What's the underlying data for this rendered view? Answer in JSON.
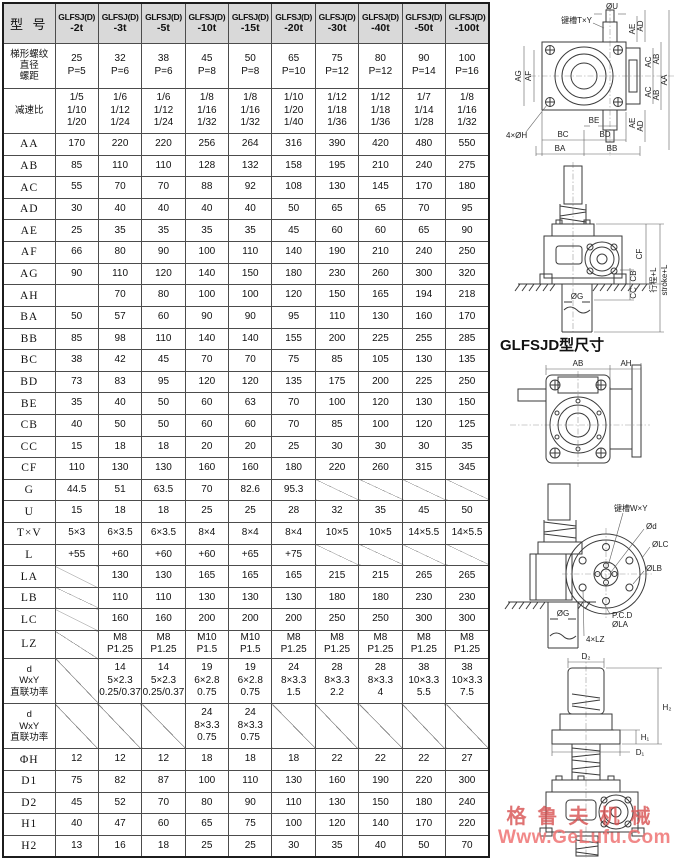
{
  "page": {
    "section_heading": "GLFSJD型尺寸",
    "watermark_line1": "格鲁夫机械",
    "watermark_line2": "Www.GeLufu.Com",
    "header_bg": "#d9d9d9",
    "watermark_color": "#d64a4a"
  },
  "table": {
    "header": {
      "corner": "型 号",
      "brand": "GLFSJ(D)",
      "models": [
        "-2t",
        "-3t",
        "-5t",
        "-10t",
        "-15t",
        "-20t",
        "-30t",
        "-40t",
        "-50t",
        "-100t"
      ]
    },
    "rows": [
      {
        "label": "梯形螺纹\n直径\n螺距",
        "values": [
          "25\nP=5",
          "32\nP=6",
          "38\nP=6",
          "45\nP=8",
          "50\nP=8",
          "65\nP=10",
          "75\nP=12",
          "80\nP=12",
          "90\nP=14",
          "100\nP=16"
        ]
      },
      {
        "label": "减速比",
        "values": [
          "1/5\n1/10\n1/20",
          "1/6\n1/12\n1/24",
          "1/6\n1/12\n1/24",
          "1/8\n1/16\n1/32",
          "1/8\n1/16\n1/32",
          "1/10\n1/20\n1/40",
          "1/12\n1/18\n1/36",
          "1/12\n1/18\n1/36",
          "1/7\n1/14\n1/28",
          "1/8\n1/16\n1/32"
        ]
      },
      {
        "label": "AA",
        "values": [
          "170",
          "220",
          "220",
          "256",
          "264",
          "316",
          "390",
          "420",
          "480",
          "550"
        ]
      },
      {
        "label": "AB",
        "values": [
          "85",
          "110",
          "110",
          "128",
          "132",
          "158",
          "195",
          "210",
          "240",
          "275"
        ]
      },
      {
        "label": "AC",
        "values": [
          "55",
          "70",
          "70",
          "88",
          "92",
          "108",
          "130",
          "145",
          "170",
          "180"
        ]
      },
      {
        "label": "AD",
        "values": [
          "30",
          "40",
          "40",
          "40",
          "40",
          "50",
          "65",
          "65",
          "70",
          "95"
        ]
      },
      {
        "label": "AE",
        "values": [
          "25",
          "35",
          "35",
          "35",
          "35",
          "45",
          "60",
          "60",
          "65",
          "90"
        ]
      },
      {
        "label": "AF",
        "values": [
          "66",
          "80",
          "90",
          "100",
          "110",
          "140",
          "190",
          "210",
          "240",
          "250"
        ]
      },
      {
        "label": "AG",
        "values": [
          "90",
          "110",
          "120",
          "140",
          "150",
          "180",
          "230",
          "260",
          "300",
          "320"
        ]
      },
      {
        "label": "AH",
        "values": [
          "",
          "70",
          "80",
          "100",
          "100",
          "120",
          "150",
          "165",
          "194",
          "218"
        ]
      },
      {
        "label": "BA",
        "values": [
          "50",
          "57",
          "60",
          "90",
          "90",
          "95",
          "110",
          "130",
          "160",
          "170"
        ]
      },
      {
        "label": "BB",
        "values": [
          "85",
          "98",
          "110",
          "140",
          "140",
          "155",
          "200",
          "225",
          "255",
          "285"
        ]
      },
      {
        "label": "BC",
        "values": [
          "38",
          "42",
          "45",
          "70",
          "70",
          "75",
          "85",
          "105",
          "130",
          "135"
        ]
      },
      {
        "label": "BD",
        "values": [
          "73",
          "83",
          "95",
          "120",
          "120",
          "135",
          "175",
          "200",
          "225",
          "250"
        ]
      },
      {
        "label": "BE",
        "values": [
          "35",
          "40",
          "50",
          "60",
          "63",
          "70",
          "100",
          "120",
          "130",
          "150"
        ]
      },
      {
        "label": "CB",
        "values": [
          "40",
          "50",
          "50",
          "60",
          "60",
          "70",
          "85",
          "100",
          "120",
          "125"
        ]
      },
      {
        "label": "CC",
        "values": [
          "15",
          "18",
          "18",
          "20",
          "20",
          "25",
          "30",
          "30",
          "30",
          "35"
        ]
      },
      {
        "label": "CF",
        "values": [
          "110",
          "130",
          "130",
          "160",
          "160",
          "180",
          "220",
          "260",
          "315",
          "345"
        ]
      },
      {
        "label": "G",
        "values": [
          "44.5",
          "51",
          "63.5",
          "70",
          "82.6",
          "95.3",
          "/",
          "/",
          "/",
          "/"
        ]
      },
      {
        "label": "U",
        "values": [
          "15",
          "18",
          "18",
          "25",
          "25",
          "28",
          "32",
          "35",
          "45",
          "50"
        ]
      },
      {
        "label": "T×V",
        "values": [
          "5×3",
          "6×3.5",
          "6×3.5",
          "8×4",
          "8×4",
          "8×4",
          "10×5",
          "10×5",
          "14×5.5",
          "14×5.5"
        ]
      },
      {
        "label": "L",
        "values": [
          "+55",
          "+60",
          "+60",
          "+60",
          "+65",
          "+75",
          "/",
          "/",
          "/",
          "/"
        ]
      },
      {
        "label": "LA",
        "values": [
          "/",
          "130",
          "130",
          "165",
          "165",
          "165",
          "215",
          "215",
          "265",
          "265"
        ]
      },
      {
        "label": "LB",
        "values": [
          "/",
          "110",
          "110",
          "130",
          "130",
          "130",
          "180",
          "180",
          "230",
          "230"
        ]
      },
      {
        "label": "LC",
        "values": [
          "/",
          "160",
          "160",
          "200",
          "200",
          "200",
          "250",
          "250",
          "300",
          "300"
        ]
      },
      {
        "label": "LZ",
        "values": [
          "/",
          "M8\nP1.25",
          "M8\nP1.25",
          "M10\nP1.5",
          "M10\nP1.5",
          "M8\nP1.25",
          "M8\nP1.25",
          "M8\nP1.25",
          "M8\nP1.25",
          "M8\nP1.25"
        ]
      },
      {
        "label": "d\nWxY\n直联功率",
        "values": [
          "/",
          "14\n5×2.3\n0.25/0.37",
          "14\n5×2.3\n0.25/0.37",
          "19\n6×2.8\n0.75",
          "19\n6×2.8\n0.75",
          "24\n8×3.3\n1.5",
          "28\n8×3.3\n2.2",
          "28\n8×3.3\n4",
          "38\n10×3.3\n5.5",
          "38\n10×3.3\n7.5"
        ]
      },
      {
        "label": "d\nWxY\n直联功率",
        "values": [
          "/",
          "/",
          "/",
          "24\n8×3.3\n0.75",
          "24\n8×3.3\n0.75",
          "/",
          "/",
          "/",
          "/",
          "/"
        ]
      },
      {
        "label": "ΦH",
        "values": [
          "12",
          "12",
          "12",
          "18",
          "18",
          "18",
          "22",
          "22",
          "22",
          "27"
        ]
      },
      {
        "label": "D1",
        "values": [
          "75",
          "82",
          "87",
          "100",
          "110",
          "130",
          "160",
          "190",
          "220",
          "300"
        ]
      },
      {
        "label": "D2",
        "values": [
          "45",
          "52",
          "70",
          "80",
          "90",
          "110",
          "130",
          "150",
          "180",
          "240"
        ]
      },
      {
        "label": "H1",
        "values": [
          "40",
          "47",
          "60",
          "65",
          "75",
          "100",
          "120",
          "140",
          "170",
          "220"
        ]
      },
      {
        "label": "H2",
        "values": [
          "13",
          "16",
          "18",
          "25",
          "25",
          "30",
          "35",
          "40",
          "50",
          "70"
        ]
      }
    ]
  },
  "diagrams": {
    "fig1": {
      "u": "ØU",
      "keyway": "键槽T×Y",
      "ae1": "AE",
      "ad1": "AD",
      "ac1": "AC",
      "ab1": "AB",
      "aa": "AA",
      "ac2": "AC",
      "ab2": "AB",
      "ae2": "AE",
      "ad2": "AD",
      "ag": "AG",
      "af": "AF",
      "holes": "4×ØH",
      "be": "BE",
      "bc": "BC",
      "bd": "BD",
      "ba": "BA",
      "bb": "BB"
    },
    "fig2": {
      "cf": "CF",
      "cb": "CB",
      "cc": "CC",
      "g": "ØG",
      "stroke_cn": "行程+L",
      "stroke_en": "stroke+L"
    },
    "fig3": {
      "ab": "AB",
      "ah": "AH"
    },
    "fig4": {
      "keyway": "键槽W×Y",
      "d": "Ød",
      "lc": "ØLC",
      "lb": "ØLB",
      "pcd": "P.C.D",
      "la": "ØLA",
      "lz": "4×LZ",
      "g": "ØG"
    },
    "fig5": {
      "d2": "D₂",
      "h2": "H₂",
      "h1": "H₁",
      "d1": "D₁"
    }
  }
}
